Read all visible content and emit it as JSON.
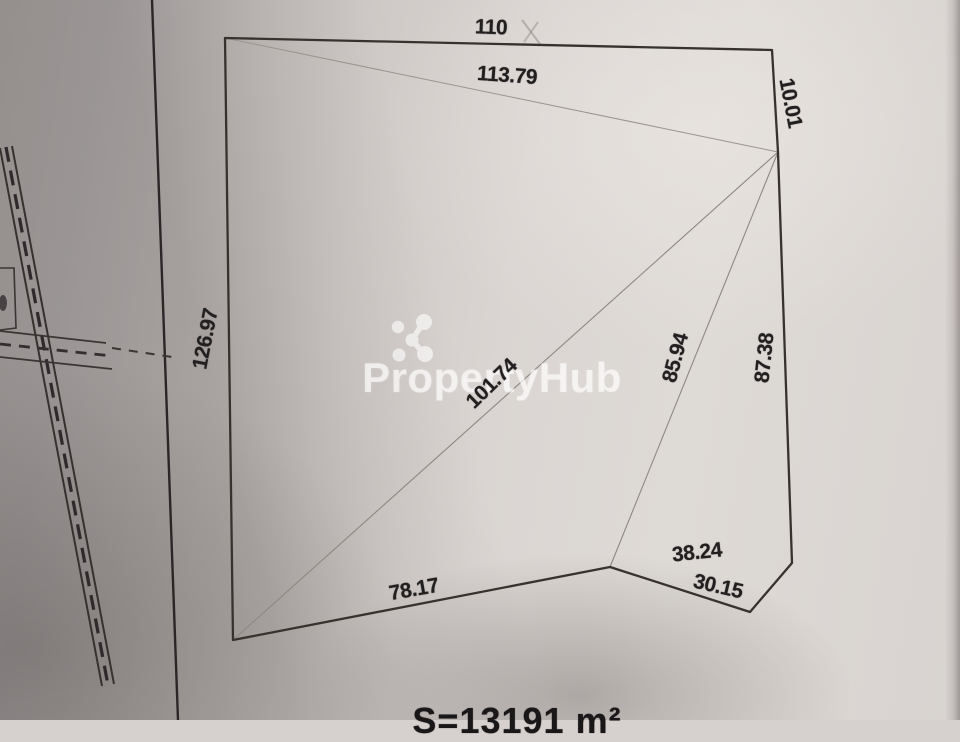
{
  "watermark": {
    "brand": "PropertyHub",
    "logo": "molecule-dots-icon"
  },
  "survey": {
    "area_text": "S=13191 m²",
    "measurements": {
      "top_side": "110",
      "top_diagonal": "113.79",
      "right_top_side": "10.01",
      "left_side": "126.97",
      "main_diagonal": "101.74",
      "inner_diagonal": "85.94",
      "right_side": "87.38",
      "bottom_side": "78.17",
      "bottom_right_side": "38.24",
      "bottom_notch_side": "30.15"
    },
    "geometry": {
      "plot_outline": "225,38 772,50 778,152 792,563 750,612 610,567 233,640",
      "diagonal_top": "225,38 778,152",
      "diagonal_main": "778,152 233,640",
      "diagonal_inner": "778,152 610,567",
      "frame_line": "152,0 178,720",
      "road_main_left": "0,148 102,686",
      "road_main_right": "12,146 114,684",
      "road_main_center": "6,147 108,685",
      "road_cross_top": "0,331 106,343",
      "road_cross_bottom": "0,357 112,369",
      "road_cross_center": "0,344 112,356",
      "road_cross_dashes": "112,348 172,357",
      "edge_box": "0,268 14,268 16,328 0,330",
      "pencil_mark_1": "522,20 540,44",
      "pencil_mark_2": "538,22 524,42"
    },
    "colors": {
      "ink": "#38322f",
      "faint_pencil": "#8e8884",
      "paper_light": "#dedad6",
      "paper_shadow": "#a8a3a1",
      "watermark_white": "#ffffff"
    }
  }
}
